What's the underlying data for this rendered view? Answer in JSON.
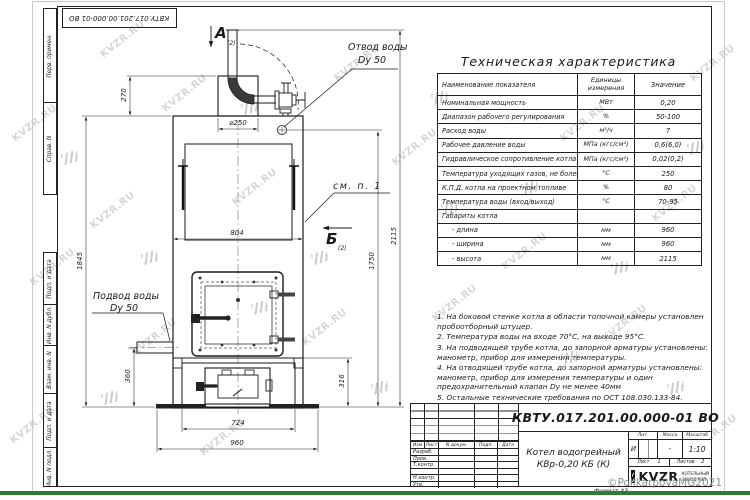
{
  "watermark": {
    "text": "KVZR.RU",
    "copyright": "©PolikarpovaMG2021"
  },
  "frame": {
    "top_designation": "КВТУ.017.201.00.000-01 ВО",
    "left_stamps_top": [
      "Перв. примен.",
      "Справ. N"
    ],
    "left_stamps_bottom": [
      "Подп. и дата",
      "Инв. N дубл.",
      "Взам. инв. N",
      "Подп. и дата",
      "Инв. N подл."
    ]
  },
  "drawing": {
    "section_label": "А",
    "section_sub": "(2)",
    "view_label": "Б",
    "view_sub": "(2)",
    "outlet_label_1": "Отвод воды",
    "outlet_label_2": "Dу 50",
    "inlet_label_1": "Подвод воды",
    "inlet_label_2": "Dу 50",
    "see_note_label": "см. п. 1",
    "dimensions": {
      "top_box_height": "270",
      "flue_diameter": "⌀250",
      "body_width": "804",
      "height_body": "1845",
      "height_outlet": "1750",
      "height_total": "2115",
      "inlet_height": "360",
      "firebox_height": "316",
      "base_width_inner": "724",
      "base_width": "960"
    }
  },
  "spec_table": {
    "title": "Техническая характеристика",
    "col_name": "Наименование показателя",
    "col_units": "Единицы измерения",
    "col_value": "Значение",
    "rows": [
      {
        "name": "Номинальная мощность",
        "units": "МВт",
        "value": "0,20"
      },
      {
        "name": "Диапазон рабочего регулирования",
        "units": "%",
        "value": "50-100"
      },
      {
        "name": "Расход воды",
        "units": "м³/ч",
        "value": "7"
      },
      {
        "name": "Рабочее давление воды",
        "units": "МПа (кгс/см²)",
        "value": "0,6(6,0)"
      },
      {
        "name": "Гидравлическое сопротивление котла",
        "units": "МПа (кгс/см²)",
        "value": "0,02(0,2)"
      },
      {
        "name": "Температура уходящих газов, не более",
        "units": "°С",
        "value": "250"
      },
      {
        "name": "К.П.Д. котла на проектном топливе",
        "units": "%",
        "value": "80"
      },
      {
        "name": "Температура воды (вход/выход)",
        "units": "°С",
        "value": "70-95"
      },
      {
        "name": "Габариты котла",
        "units": "",
        "value": ""
      },
      {
        "name": "- длина",
        "units": "мм",
        "value": "960"
      },
      {
        "name": "- ширина",
        "units": "мм",
        "value": "960"
      },
      {
        "name": "- высота",
        "units": "мм",
        "value": "2115"
      }
    ]
  },
  "notes": [
    "1. На боковой стенке котла в области топочной камеры установлен пробоотборный штуцер.",
    "2. Температура воды на входе 70°С, на выходе 95°С.",
    "3. На подводящей трубе котла, до запорной арматуры установлены: манометр, прибор для измерения температуры.",
    "4. На отводящей трубе котла, до запорной арматуры установлены: манометр, прибор для измерения температуры и один предохранительный клапан Dу не менее 40мм",
    "5. Остальные технические требования по ОСТ 108.030.133-84."
  ],
  "title_block": {
    "designation": "КВТУ.017.201.00.000-01 ВО",
    "product_line1": "Котел водогрейный",
    "product_line2": "КВр-0,20 КБ (К)",
    "change_header": [
      "Изм",
      "Лист",
      "N докум.",
      "Подп.",
      "Дата"
    ],
    "role_rows": [
      "Разраб.",
      "Пров.",
      "Т.контр.",
      "",
      "Н.контр.",
      "Утв."
    ],
    "lit_label": "Лит.",
    "mass_label": "Масса",
    "scale_label": "Масштаб",
    "lit_value": "И",
    "mass_value": "-",
    "scale_value": "1:10",
    "sheet_label": "Лист",
    "sheet_value": "1",
    "sheets_label": "Листов",
    "sheets_value": "2",
    "logo_text": "KVZR",
    "logo_sub1": "КОТЕЛЬНЫЙ",
    "logo_sub2": "ЗАВОД РЭП",
    "format_label": "Формат А3"
  }
}
